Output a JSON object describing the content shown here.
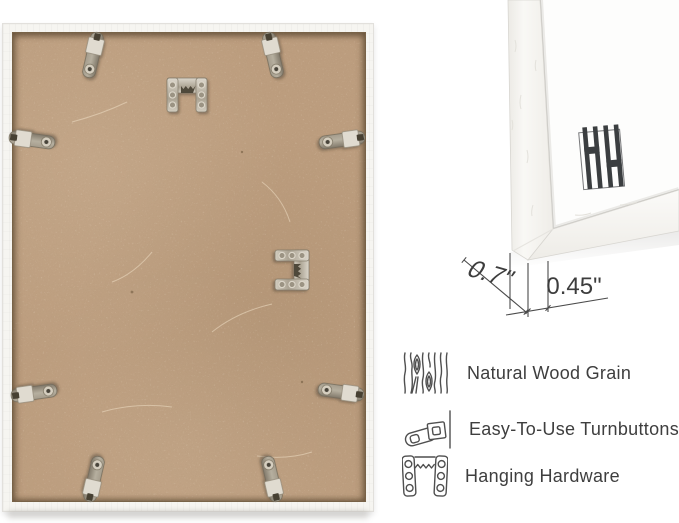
{
  "photo": {
    "subject": "back of white picture frame with MDF backing board",
    "turnbutton_count": 8,
    "hanger_count": 2,
    "backing_color": "#bc9d7e",
    "frame_color": "#f6f5f1",
    "metal_color": "#a89f8e"
  },
  "corner_diagram": {
    "depth_dimension": "0.7\"",
    "face_dimension": "0.45\"",
    "logo_icon": "hh-monogram-logo"
  },
  "features": {
    "items": [
      {
        "icon": "wood-grain-icon",
        "label": "Natural Wood Grain"
      },
      {
        "icon": "turnbutton-icon",
        "label": "Easy-To-Use Turnbuttons"
      },
      {
        "icon": "hanging-hardware-icon",
        "label": "Hanging Hardware"
      }
    ]
  },
  "colors": {
    "background": "#ffffff",
    "text": "#3e3e3e",
    "dimension_lines": "#4a4a4a",
    "logo": "#3b3e40"
  }
}
